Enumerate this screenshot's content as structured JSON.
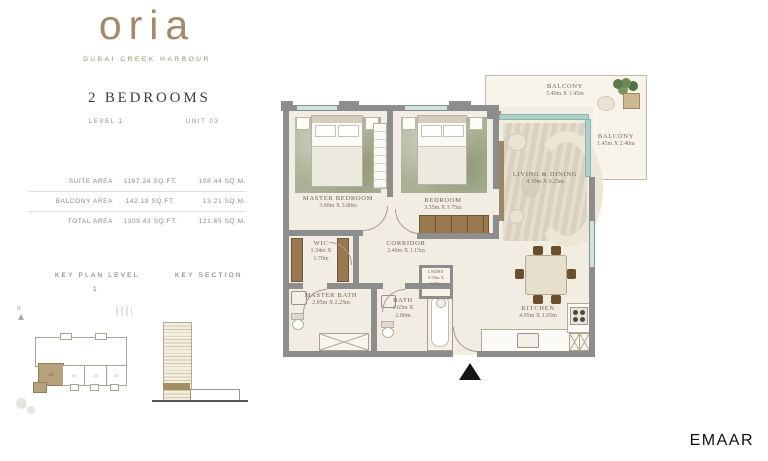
{
  "brand": {
    "logo": "oria",
    "tagline": "DUBAI CREEK HARBOUR"
  },
  "header": {
    "title": "2 BEDROOMS",
    "level": "LEVEL 1",
    "unit": "UNIT 03"
  },
  "area_table": {
    "rows": [
      {
        "label": "SUITE AREA",
        "sqft": "1167.24 SQ.FT.",
        "sqm": "108.44 SQ.M."
      },
      {
        "label": "BALCONY AREA",
        "sqft": "142.19 SQ.FT.",
        "sqm": "13.21 SQ.M."
      },
      {
        "label": "TOTAL AREA",
        "sqft": "1309.43 SQ.FT.",
        "sqm": "121.65 SQ.M."
      }
    ]
  },
  "key_plan": {
    "title": "KEY PLAN LEVEL",
    "level": "1",
    "north": "N",
    "units": [
      {
        "id": "03",
        "highlighted": true
      },
      {
        "id": "04",
        "highlighted": false
      },
      {
        "id": "05",
        "highlighted": false
      },
      {
        "id": "06",
        "highlighted": false
      }
    ]
  },
  "key_section": {
    "title": "KEY SECTION"
  },
  "plan": {
    "balcony_top": {
      "name": "BALCONY",
      "dims": "5.40m X 1.45m"
    },
    "balcony_right": {
      "name": "BALCONY",
      "dims": "1.45m X 2.40m"
    },
    "living": {
      "name": "LIVING & DINING",
      "dims": "4.10m X 6.25m"
    },
    "master_bedroom": {
      "name": "MASTER BEDROOM",
      "dims": "3.60m X 3.80m"
    },
    "bedroom": {
      "name": "BEDROOM",
      "dims": "3.55m X 3.75m"
    },
    "wic": {
      "name": "WIC",
      "dims_a": "1.34m X",
      "dims_b": "1.70m"
    },
    "corridor": {
      "name": "CORRIDOR",
      "dims": "2.40m X 1.15m"
    },
    "master_bath": {
      "name": "MASTER BATH",
      "dims": "2.95m X 2.25m"
    },
    "bath": {
      "name": "BATH",
      "dims_a": "1.65m X",
      "dims_b": "2.80m"
    },
    "laundry": {
      "name": "LNDRY",
      "dims_a": "0.95m X",
      "dims_b": "0.70m"
    },
    "kitchen": {
      "name": "KITCHEN",
      "dims": "4.95m X 1.95m"
    }
  },
  "footer": {
    "brand": "EMAAR"
  },
  "colors": {
    "accent_tan": "#a38b69",
    "wall_gray": "#8d8d8d",
    "rug_green": "#a9b094",
    "glass_teal": "#aed0cb",
    "highlight_tan": "#b5a27c"
  }
}
